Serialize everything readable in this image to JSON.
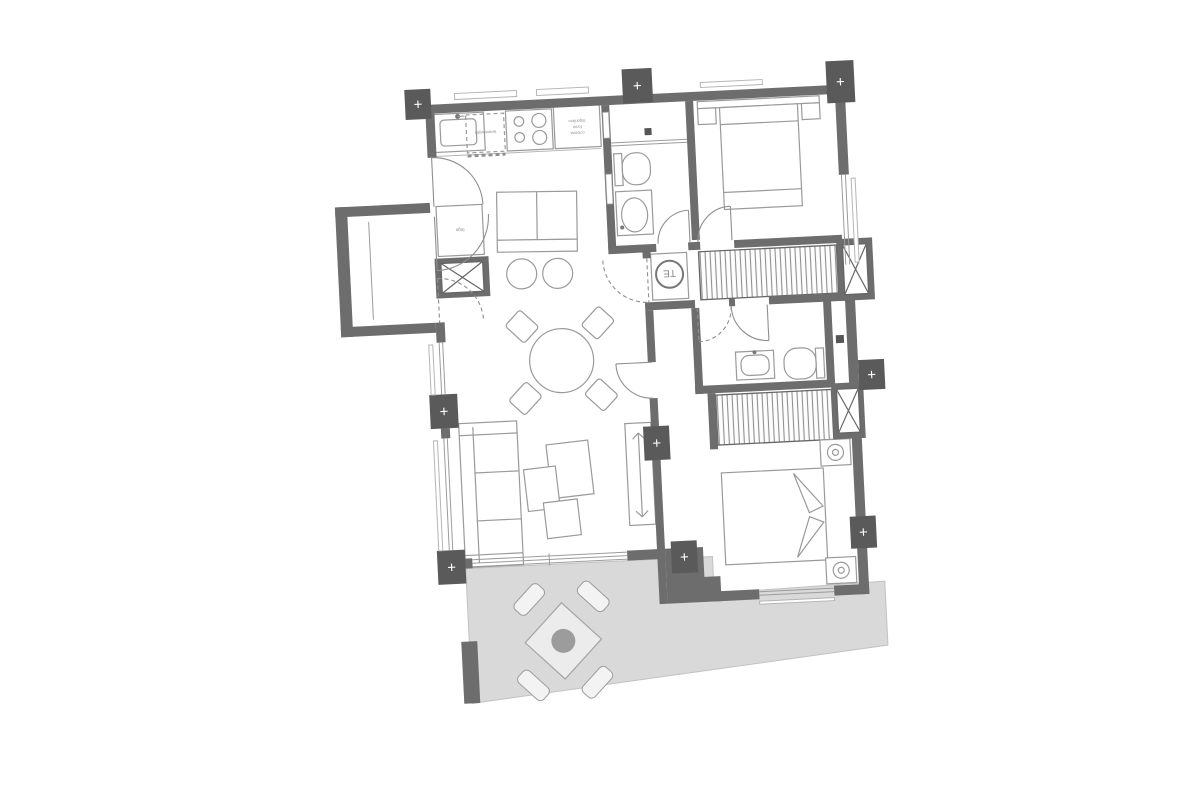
{
  "plan": {
    "labels": {
      "dishwasher": "lavastoviglie",
      "tall_unit": {
        "line1": "colonna",
        "line2": "forno",
        "line3": "frigorifero"
      },
      "fridge": "frigo",
      "water_heater": "TE",
      "column_marker": "+"
    },
    "colors": {
      "wall": "#6d6d6d",
      "column_marker_block": "#5a5a5a",
      "terrace_floor": "#d9d9d9",
      "furniture_stroke": "#9a9a9a",
      "background": "#ffffff"
    },
    "rotation_deg": -2.8
  }
}
